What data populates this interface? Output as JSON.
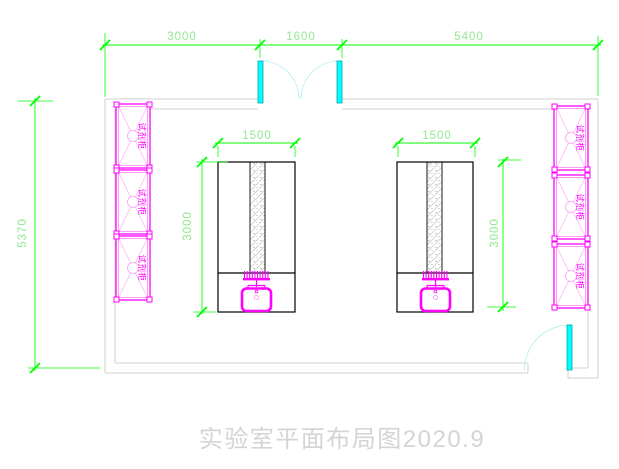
{
  "drawing": {
    "title": "实验室平面布局图2020.9",
    "dimensions": {
      "top_left_span": "3000",
      "door_opening": "1600",
      "top_right_span": "5400",
      "room_height": "5370",
      "bench_width": "1500",
      "bench_length": "3000"
    },
    "cabinet_label": "试剂柜",
    "colors": {
      "dimension_line": "#00ff00",
      "dimension_text": "#8fe88f",
      "cabinet": "#ff00ff",
      "door_leaf": "#00ffff",
      "door_swing": "#bdeff2",
      "wall": "#d2d2d2",
      "bench_outline": "#000000",
      "title_text": "#d4d4d4"
    }
  }
}
